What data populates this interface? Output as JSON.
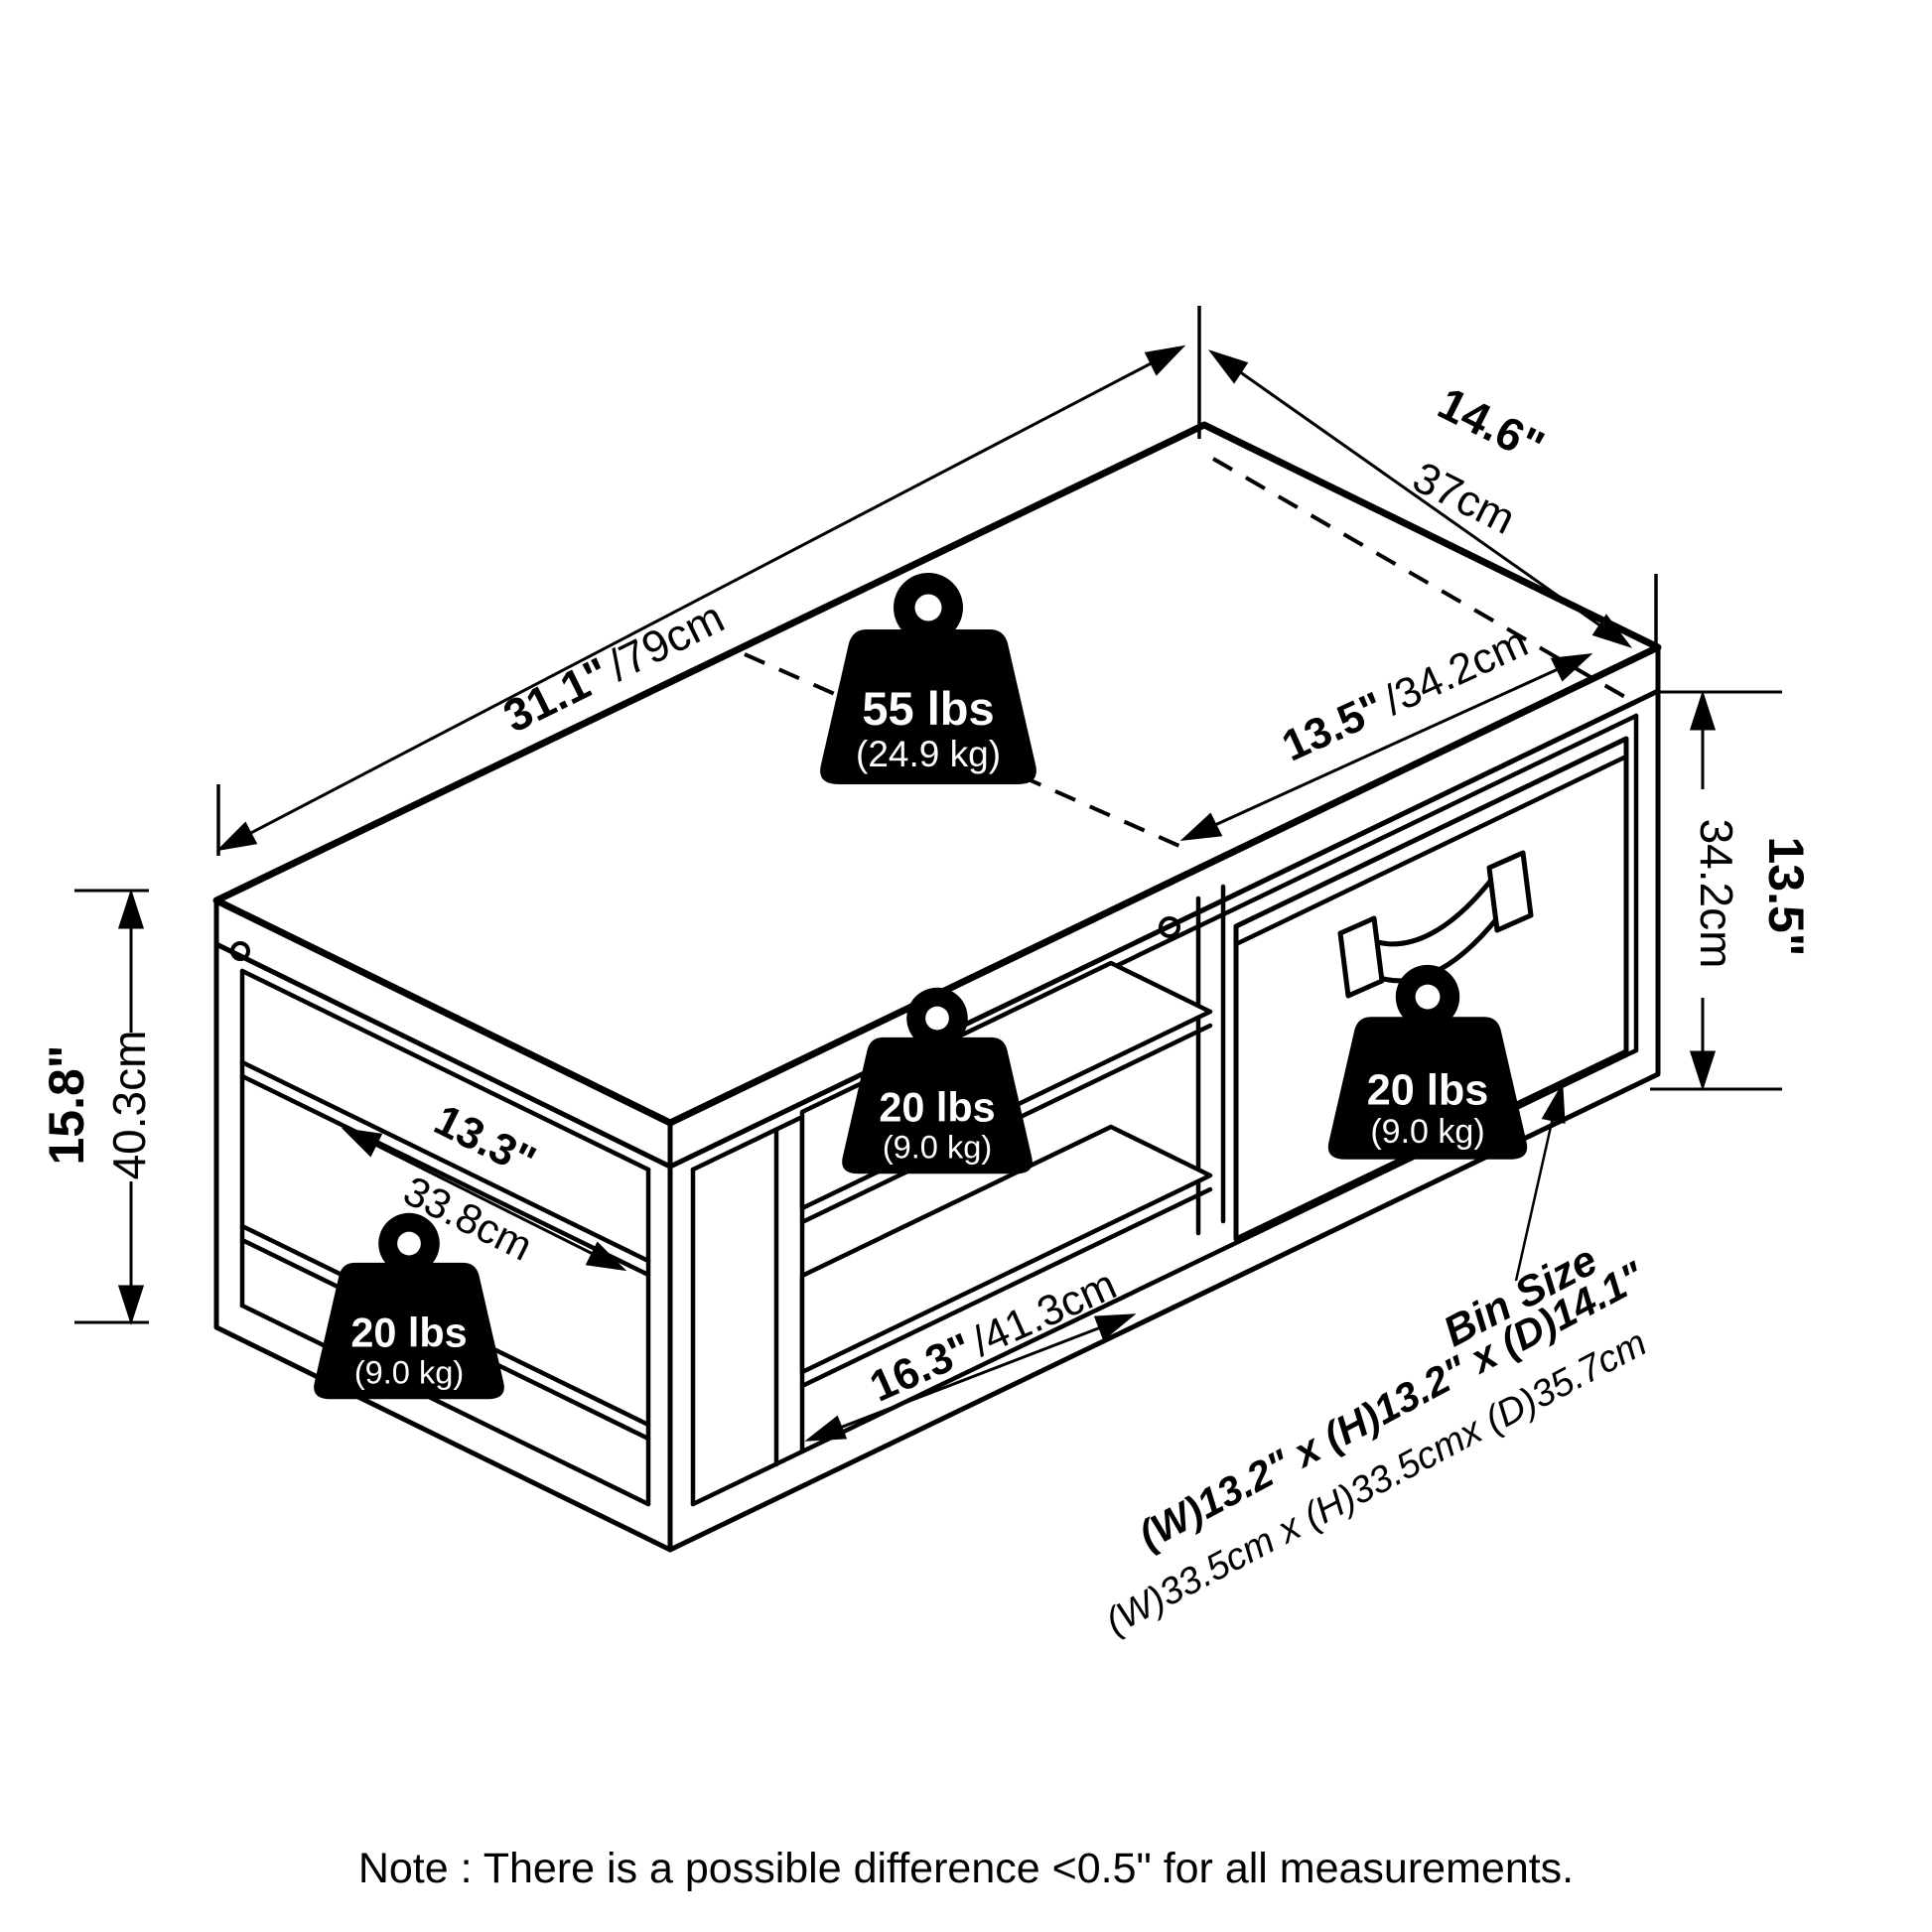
{
  "note": "Note : There is a possible difference <0.5\" for all measurements.",
  "colors": {
    "ink": "#000000",
    "paper": "#ffffff"
  },
  "dims": {
    "width_in": "31.1\"",
    "width_cm": "/79cm",
    "depth_in": "14.6\"",
    "depth_cm": "37cm",
    "half_in": "13.5\"",
    "half_cm": "/34.2cm",
    "height_in": "15.8\"",
    "height_cm": "40.3cm",
    "bin_h_in": "13.5\"",
    "bin_h_cm": "34.2cm",
    "shelf_d_in": "13.3\"",
    "shelf_d_cm": "33.8cm",
    "shelf_w_in": "16.3\"",
    "shelf_w_cm": "/41.3cm"
  },
  "weights": {
    "top": {
      "lbs": "55 lbs",
      "kg": "(24.9 kg)"
    },
    "middle": {
      "lbs": "20 lbs",
      "kg": "(9.0 kg)"
    },
    "side": {
      "lbs": "20 lbs",
      "kg": "(9.0 kg)"
    },
    "bin": {
      "lbs": "20 lbs",
      "kg": "(9.0 kg)"
    }
  },
  "bin_size": {
    "title": "Bin Size",
    "inches": "(W)13.2\" x (H)13.2\" x (D)14.1\"",
    "cm": "(W)33.5cm x (H)33.5cmx (D)35.7cm"
  }
}
